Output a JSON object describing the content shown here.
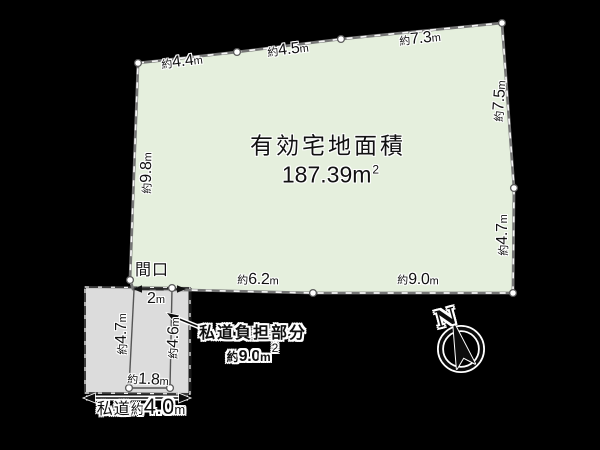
{
  "colors": {
    "background": "#000000",
    "plot_fill": "#e5efdd",
    "road_fill": "#dcdcdc",
    "boundary_line": "#777777",
    "text": "#111111"
  },
  "main_plot": {
    "area_title": "有効宅地面積",
    "area_value": "187.39",
    "area_unit": "m",
    "area_exp": "2",
    "edge_labels": {
      "top": [
        {
          "prefix": "約",
          "value": "4.4",
          "unit": "m"
        },
        {
          "prefix": "約",
          "value": "4.5",
          "unit": "m"
        },
        {
          "prefix": "約",
          "value": "7.3",
          "unit": "m"
        }
      ],
      "right": [
        {
          "prefix": "約",
          "value": "7.5",
          "unit": "m"
        },
        {
          "prefix": "約",
          "value": "4.7",
          "unit": "m"
        }
      ],
      "bottom": [
        {
          "prefix": "約",
          "value": "6.2",
          "unit": "m"
        },
        {
          "prefix": "約",
          "value": "9.0",
          "unit": "m"
        }
      ],
      "left": [
        {
          "prefix": "約",
          "value": "9.8",
          "unit": "m"
        }
      ]
    },
    "frontage": {
      "label": "間口",
      "value": "2",
      "unit": "m"
    }
  },
  "road_plot": {
    "left_edge": {
      "prefix": "約",
      "value": "4.7",
      "unit": "m"
    },
    "right_edge": {
      "prefix": "約",
      "value": "4.6",
      "unit": "m"
    },
    "bottom_edge": {
      "prefix": "約",
      "value": "1.8",
      "unit": "m"
    },
    "road": {
      "label": "私道",
      "prefix": "約",
      "value": "4.0",
      "unit": "m"
    },
    "burden": {
      "title": "私道負担部分",
      "prefix": "約",
      "value": "9.0",
      "unit": "m",
      "exp": "2"
    }
  },
  "compass": {
    "label": "N"
  }
}
